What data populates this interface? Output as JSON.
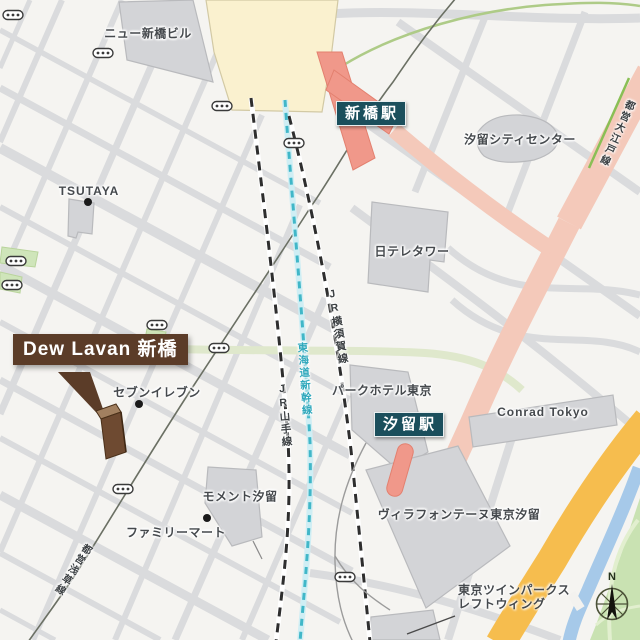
{
  "labels": {
    "new_shimbashi_building": "ニュー新橋ビル",
    "tsutaya": "TSUTAYA",
    "shiodome_city_center": "汐留シティセンター",
    "ntv_tower": "日テレタワー",
    "park_hotel_tokyo": "パークホテル東京",
    "conrad_tokyo": "Conrad Tokyo",
    "villa_fontaine": "ヴィラフォンテーヌ東京汐留",
    "moment_shiodome": "モメント汐留",
    "familymart": "ファミリーマート",
    "seven_eleven": "セブンイレブン",
    "twin_parks_line1": "東京ツインパークス",
    "twin_parks_line2": "レフトウィング"
  },
  "stations": {
    "shimbashi": "新橋駅",
    "shiodome": "汐留駅"
  },
  "rail_lines": {
    "jr_yokosuka": "JR横須賀線",
    "tokaido_shinkansen": "東海道新幹線",
    "jr_yamanote": "JR山手線",
    "toei_oedo": "都営大江戸線",
    "toei_asakusa": "都営浅草線"
  },
  "marker": {
    "title": "Dew Lavan 新橋"
  },
  "compass": {
    "north": "N"
  },
  "colors": {
    "station_badge_bg": "#1b4f5c",
    "marker_brown": "#5b3c28",
    "shinkansen_teal": "#41b7c8",
    "jr_line_black": "#2e2e2e",
    "road_pink": "#f4c9ba",
    "station_salmon": "#f0988a",
    "road_orange": "#f6bd4e",
    "water_blue": "#a6c9e9",
    "park_green": "#c9e2b2",
    "oedo_green": "#8abf55",
    "building_gray": "#d3d4d7",
    "station_building_cream": "#faf1cf"
  }
}
